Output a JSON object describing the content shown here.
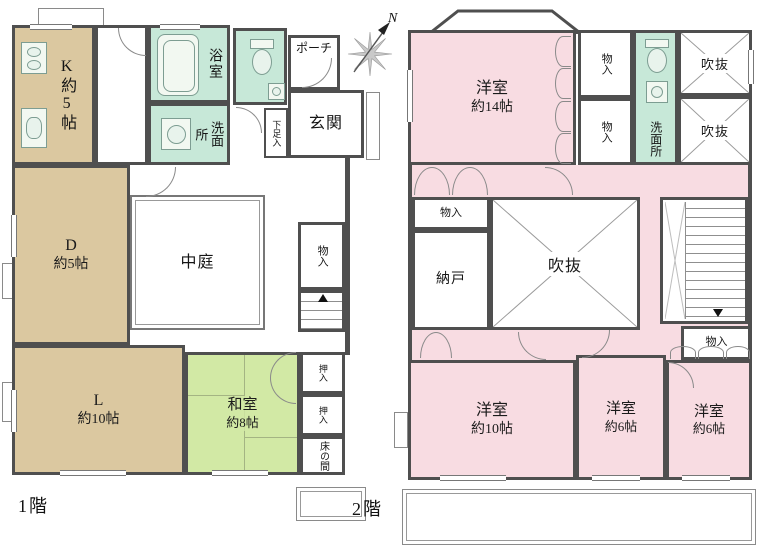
{
  "north": {
    "label": "N"
  },
  "floor1": {
    "caption": "1階",
    "kitchen": {
      "label": "K約5帖"
    },
    "dining": {
      "name": "D",
      "size": "約5帖"
    },
    "living": {
      "name": "L",
      "size": "約10帖"
    },
    "washitsu": {
      "name": "和室",
      "size": "約8帖"
    },
    "courtyard": {
      "label": "中庭"
    },
    "bath": {
      "label": "浴室"
    },
    "washroom": {
      "label": "洗面所"
    },
    "porch": {
      "label": "ポーチ"
    },
    "entrance": {
      "label": "玄関"
    },
    "shoe_box": {
      "label": "下足入"
    },
    "storage": {
      "label": "物入"
    },
    "closet_upper": {
      "label": "押入"
    },
    "closet_lower": {
      "label": "押入"
    },
    "tokonoma": {
      "label": "床の間"
    }
  },
  "floor2": {
    "caption": "2階",
    "bedroom_14": {
      "name": "洋室",
      "size": "約14帖"
    },
    "bedroom_10": {
      "name": "洋室",
      "size": "約10帖"
    },
    "bedroom_6_center papers": null,
    "bedroom_6_center": {
      "name": "洋室",
      "size": "約6帖"
    },
    "bedroom_6_right": {
      "name": "洋室",
      "size": "約6帖"
    },
    "storage_top_1": {
      "label": "物入"
    },
    "storage_top_2": {
      "label": "物入"
    },
    "storage_center": {
      "label": "物入"
    },
    "storage_stairs": {
      "label": "物入"
    },
    "washroom": {
      "label": "洗面所"
    },
    "void_top_1": {
      "label": "吹抜"
    },
    "void_top_2": {
      "label": "吹抜"
    },
    "void_center": {
      "label": "吹抜"
    },
    "nando": {
      "label": "納戸"
    }
  }
}
